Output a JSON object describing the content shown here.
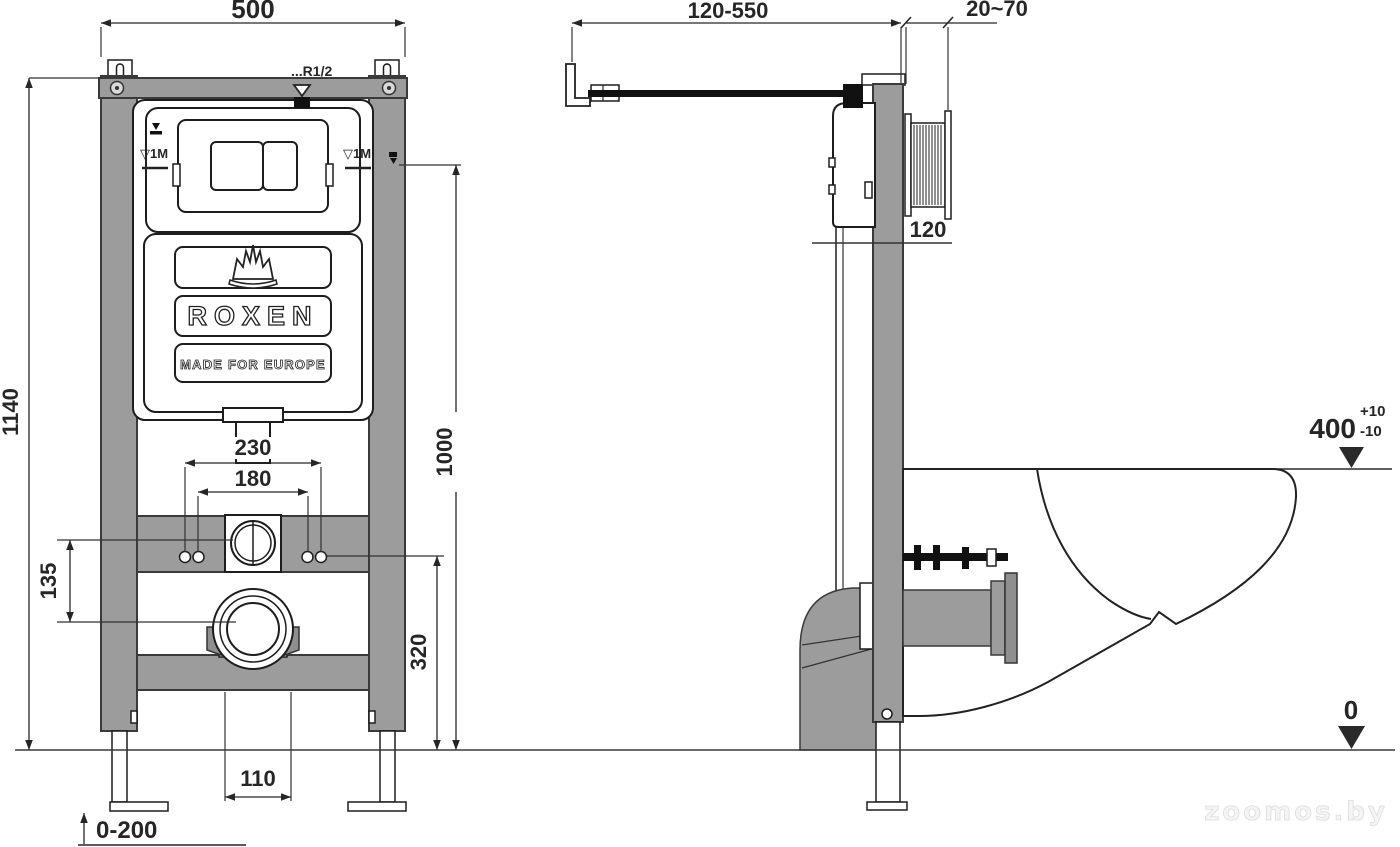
{
  "front_view": {
    "dims": {
      "width": "500",
      "height": "1140",
      "flush_plate_center_height": "1000",
      "fixing_spacing_outer": "230",
      "fixing_spacing_inner": "180",
      "inlet_to_outlet": "135",
      "outlet_height": "320",
      "outlet_offset": "110",
      "leg_adjustment": "0-200"
    },
    "labels": {
      "water_inlet_thread": "...R1/2",
      "level_mark_left": "▽1M",
      "level_mark_right": "▽1M"
    },
    "logo": {
      "brand": "ROXEN",
      "tagline": "MADE FOR EUROPE"
    }
  },
  "side_view": {
    "dims": {
      "wall_bracket_range": "120-550",
      "wall_finish_range": "20~70",
      "frame_depth": "120",
      "bowl_top_height": "400",
      "bowl_height_tolerance_plus": "+10",
      "bowl_height_tolerance_minus": "-10",
      "floor_level": "0"
    }
  },
  "watermark": "zoomos.by",
  "colors": {
    "frame_gray": "#9c9c9c",
    "pipe_dark_gray": "#8f8f8f",
    "line_dark": "#1d1d1d",
    "dimension_text": "#262626",
    "watermark_gray": "#dcdcdc"
  }
}
